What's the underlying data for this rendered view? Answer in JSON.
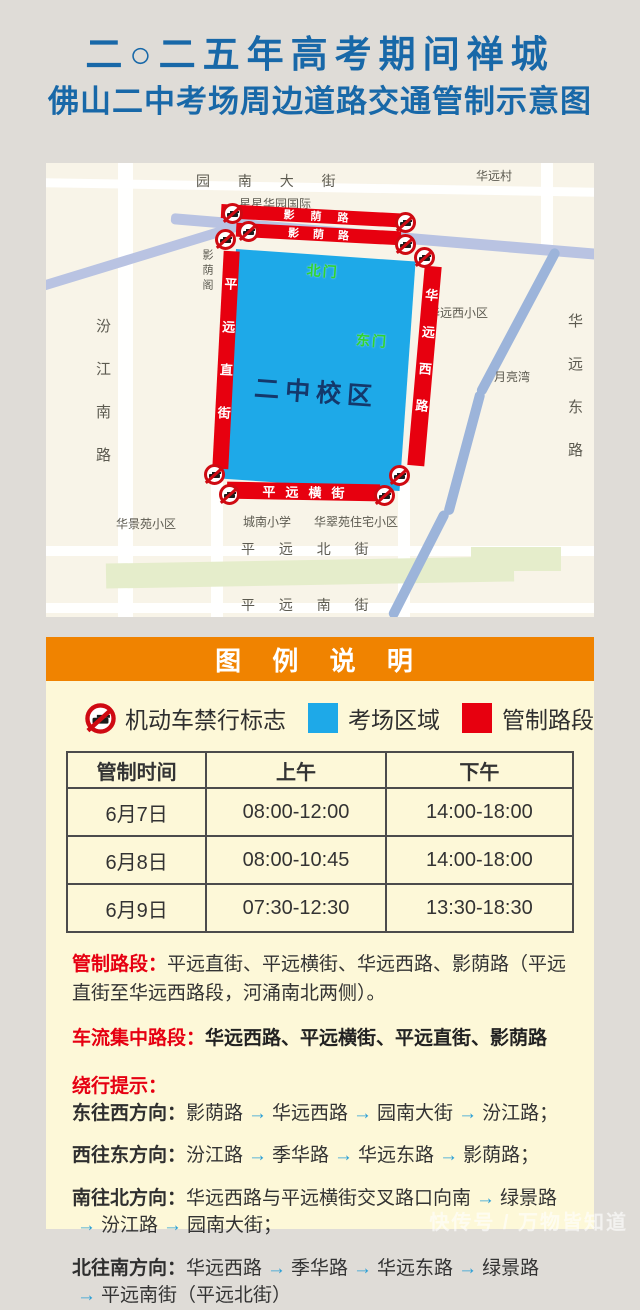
{
  "title": {
    "line1": "二○二五年高考期间禅城",
    "line2": "佛山二中考场周边道路交通管制示意图"
  },
  "map": {
    "labels": {
      "yuannan_street": "园 南 大 街",
      "huayuan_village": "华远村",
      "xingxing_estate": "星星华园国际",
      "yingyin_pavilion": "影荫阁",
      "fenjiang_south_road": "汾江南路",
      "huayuan_west_estate": "华远西小区",
      "moon_bay": "月亮湾",
      "huayuan_east_road": "华远东路",
      "huajing_estate": "华景苑小区",
      "chengnan_school": "城南小学",
      "huacui_estate": "华翠苑住宅小区",
      "pingyuan_north_street": "平 远 北 街",
      "pingyuan_south_street": "平 远 南 街",
      "north_gate": "北门",
      "east_gate": "东门",
      "campus": "二中校区"
    },
    "controlled": {
      "yingyin_north": "影荫路",
      "yingyin_south": "影荫路",
      "pingyuan_straight": "平远直街",
      "huayuan_west": "华远西路",
      "pingyuan_heng": "平远横街"
    }
  },
  "legend": {
    "header": "图 例 说 明",
    "items": [
      {
        "label": "机动车禁行标志",
        "icon": "no-entry-sign"
      },
      {
        "label": "考场区域",
        "swatch": "#1ea9e8"
      },
      {
        "label": "管制路段",
        "swatch": "#e7000f"
      }
    ]
  },
  "table": {
    "headers": [
      "管制时间",
      "上午",
      "下午"
    ],
    "rows": [
      [
        "6月7日",
        "08:00-12:00",
        "14:00-18:00"
      ],
      [
        "6月8日",
        "08:00-10:45",
        "14:00-18:00"
      ],
      [
        "6月9日",
        "07:30-12:30",
        "13:30-18:30"
      ]
    ]
  },
  "sections": {
    "controlled_label": "管制路段：",
    "controlled_text": "平远直街、平远横街、华远西路、影荫路（平远直街至华远西路段，河涌南北两侧）。",
    "busy_label": "车流集中路段：",
    "busy_text": "华远西路、平远横街、平远直街、影荫路",
    "detour_label": "绕行提示：",
    "routes": [
      {
        "label": "东往西方向：",
        "segments": [
          "影荫路",
          "华远西路",
          "园南大街",
          "汾江路；"
        ]
      },
      {
        "label": "西往东方向：",
        "segments": [
          "汾江路",
          "季华路",
          "华远东路",
          "影荫路；"
        ]
      },
      {
        "label": "南往北方向：",
        "segments": [
          "华远西路与平远横街交叉路口向南",
          "绿景路",
          "汾江路",
          "园南大街；"
        ]
      },
      {
        "label": "北往南方向：",
        "segments": [
          "华远西路",
          "季华路",
          "华远东路",
          "绿景路",
          "平远南街（平远北街）"
        ]
      }
    ]
  },
  "watermark": "快传号 / 万物皆知道",
  "colors": {
    "title_blue": "#1868a8",
    "accent_orange": "#f08300",
    "exam_area_blue": "#1ea9e8",
    "restricted_red": "#e7000f",
    "panel_yellow": "#fdf8d8",
    "gate_green": "#2ed52e"
  }
}
